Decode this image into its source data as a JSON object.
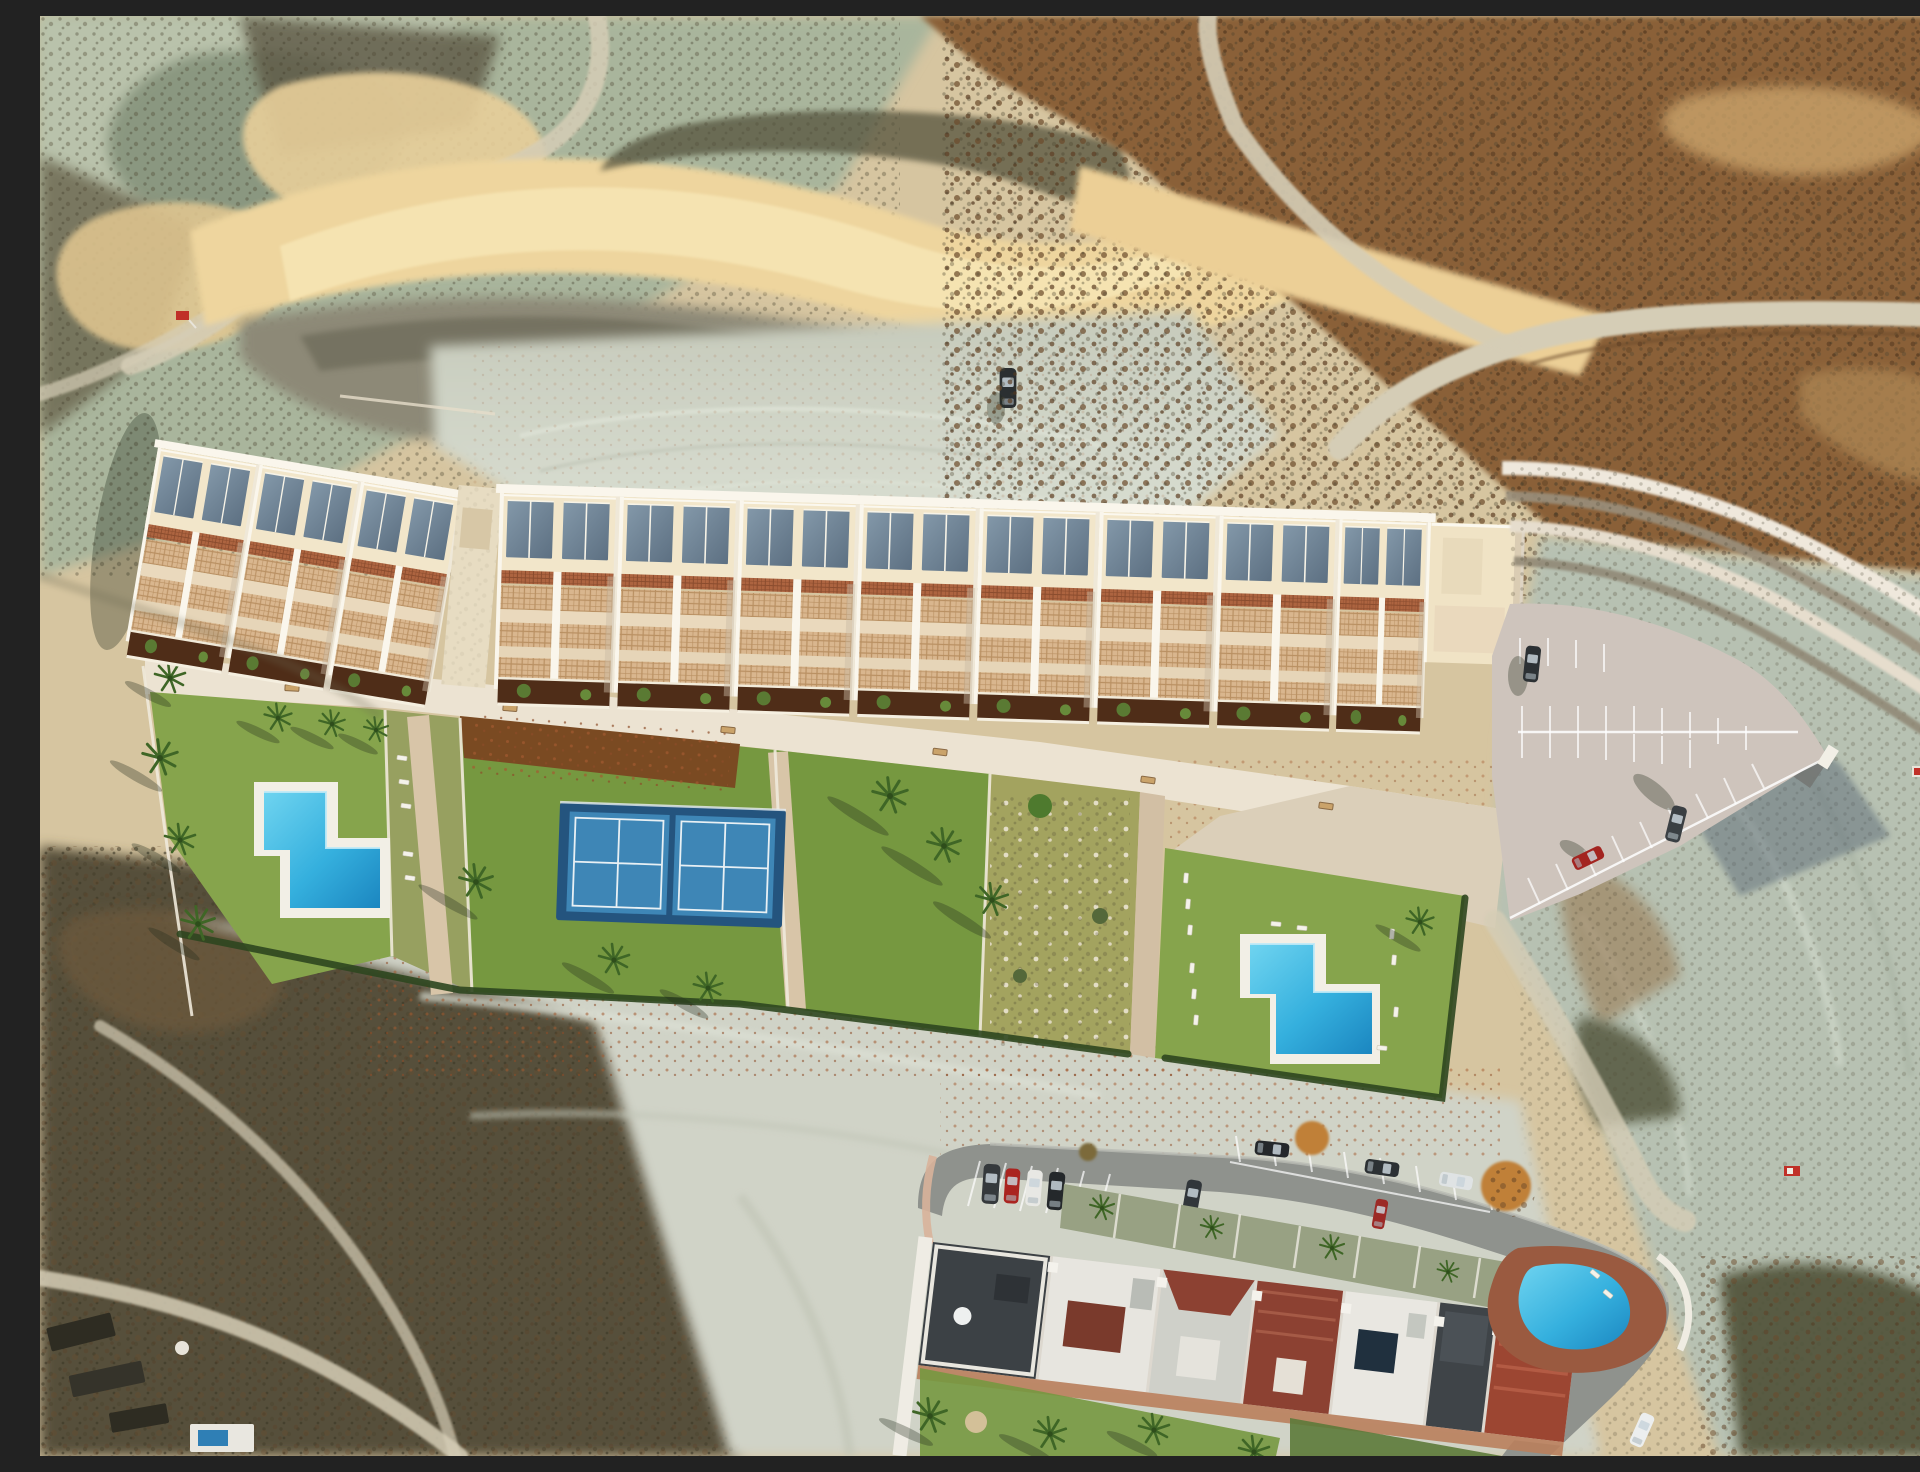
{
  "meta": {
    "title": "Aerial drone view of a new hillside residential development beside an existing coastal apartment complex",
    "view": "top-down aerial photograph, arid badlands terrain, late-afternoon light with long shadows"
  },
  "palette": {
    "sandBase": "#d6c5a0",
    "sunSand": "#eed59e",
    "sunSandBright": "#f5e3b1",
    "paleDirt": "#ced3c6",
    "paleDirt2": "#dee2d7",
    "sageGreen": "#a9b59c",
    "sageDark": "#8a9780",
    "scrubBrown": "#8a6138",
    "darkScrub": "#564f3a",
    "ravine": "#8d8977",
    "lawnGreen": "#769840",
    "lawnGreen2": "#86a44c",
    "lawnDry": "#a3a35f",
    "mulch": "#4f2d18",
    "bush": "#5a7a33",
    "poolBlue": "#3bb9e6",
    "poolDeep": "#1b86c0",
    "courtBlue": "#3e86b6",
    "courtSurround": "#24547e",
    "roofCream": "#f2e6ca",
    "wallWhite": "#faf6ec",
    "glassBlue": "#74899c",
    "pergola": "#ad6440",
    "lattice": "#d9b68e",
    "promenade": "#ece3d2",
    "pathTan": "#d8c5a8",
    "parking": "#cec4bc",
    "asphalt": "#8f928d",
    "roofCharcoal": "#3c4145",
    "roofRed": "#93412f",
    "deckTerracotta": "#9a5a40",
    "autumnTree": "#c08038",
    "signRed": "#c03028"
  },
  "scene": {
    "new_development": {
      "townhouse_blocks": [
        {
          "name": "left angled block",
          "units": 3
        },
        {
          "name": "main row",
          "units": 8
        }
      ],
      "roof_glazing_panels_per_unit": 2,
      "amenities": {
        "swimming_pools": [
          {
            "name": "west communal pool",
            "shape": "L-shaped"
          },
          {
            "name": "east communal pool",
            "shape": "L-shaped"
          }
        ],
        "padel_courts": 2,
        "parking_lot": {
          "marked_bays": true,
          "cars_parked": 3
        },
        "promenade_benches": 6,
        "sun_loungers": 14
      }
    },
    "existing_complex": {
      "street_cars_parked": 10,
      "rooftop_colors": [
        "charcoal",
        "white",
        "terracotta"
      ],
      "pool": {
        "name": "existing complex pool",
        "shape": "rounded"
      }
    },
    "terrain_features": [
      "eroded badlands gully with sunlit sand crescent",
      "graded pale dirt bowl with lone parked car",
      "brown scrub hillside with winding dirt road",
      "dark scrubland with foot trails and sheds (bottom left)"
    ],
    "small_red_signs": 3,
    "palm_trees_visible": 20
  },
  "caption": "Aerial render: white stepped townhouses with rooftop glazing and terracotta pergolas, two L-shaped pools, twin padel courts, fan-marked parking lot behind a curved retaining wall, existing apartment row with street parking below, all set in arid eroded hills."
}
